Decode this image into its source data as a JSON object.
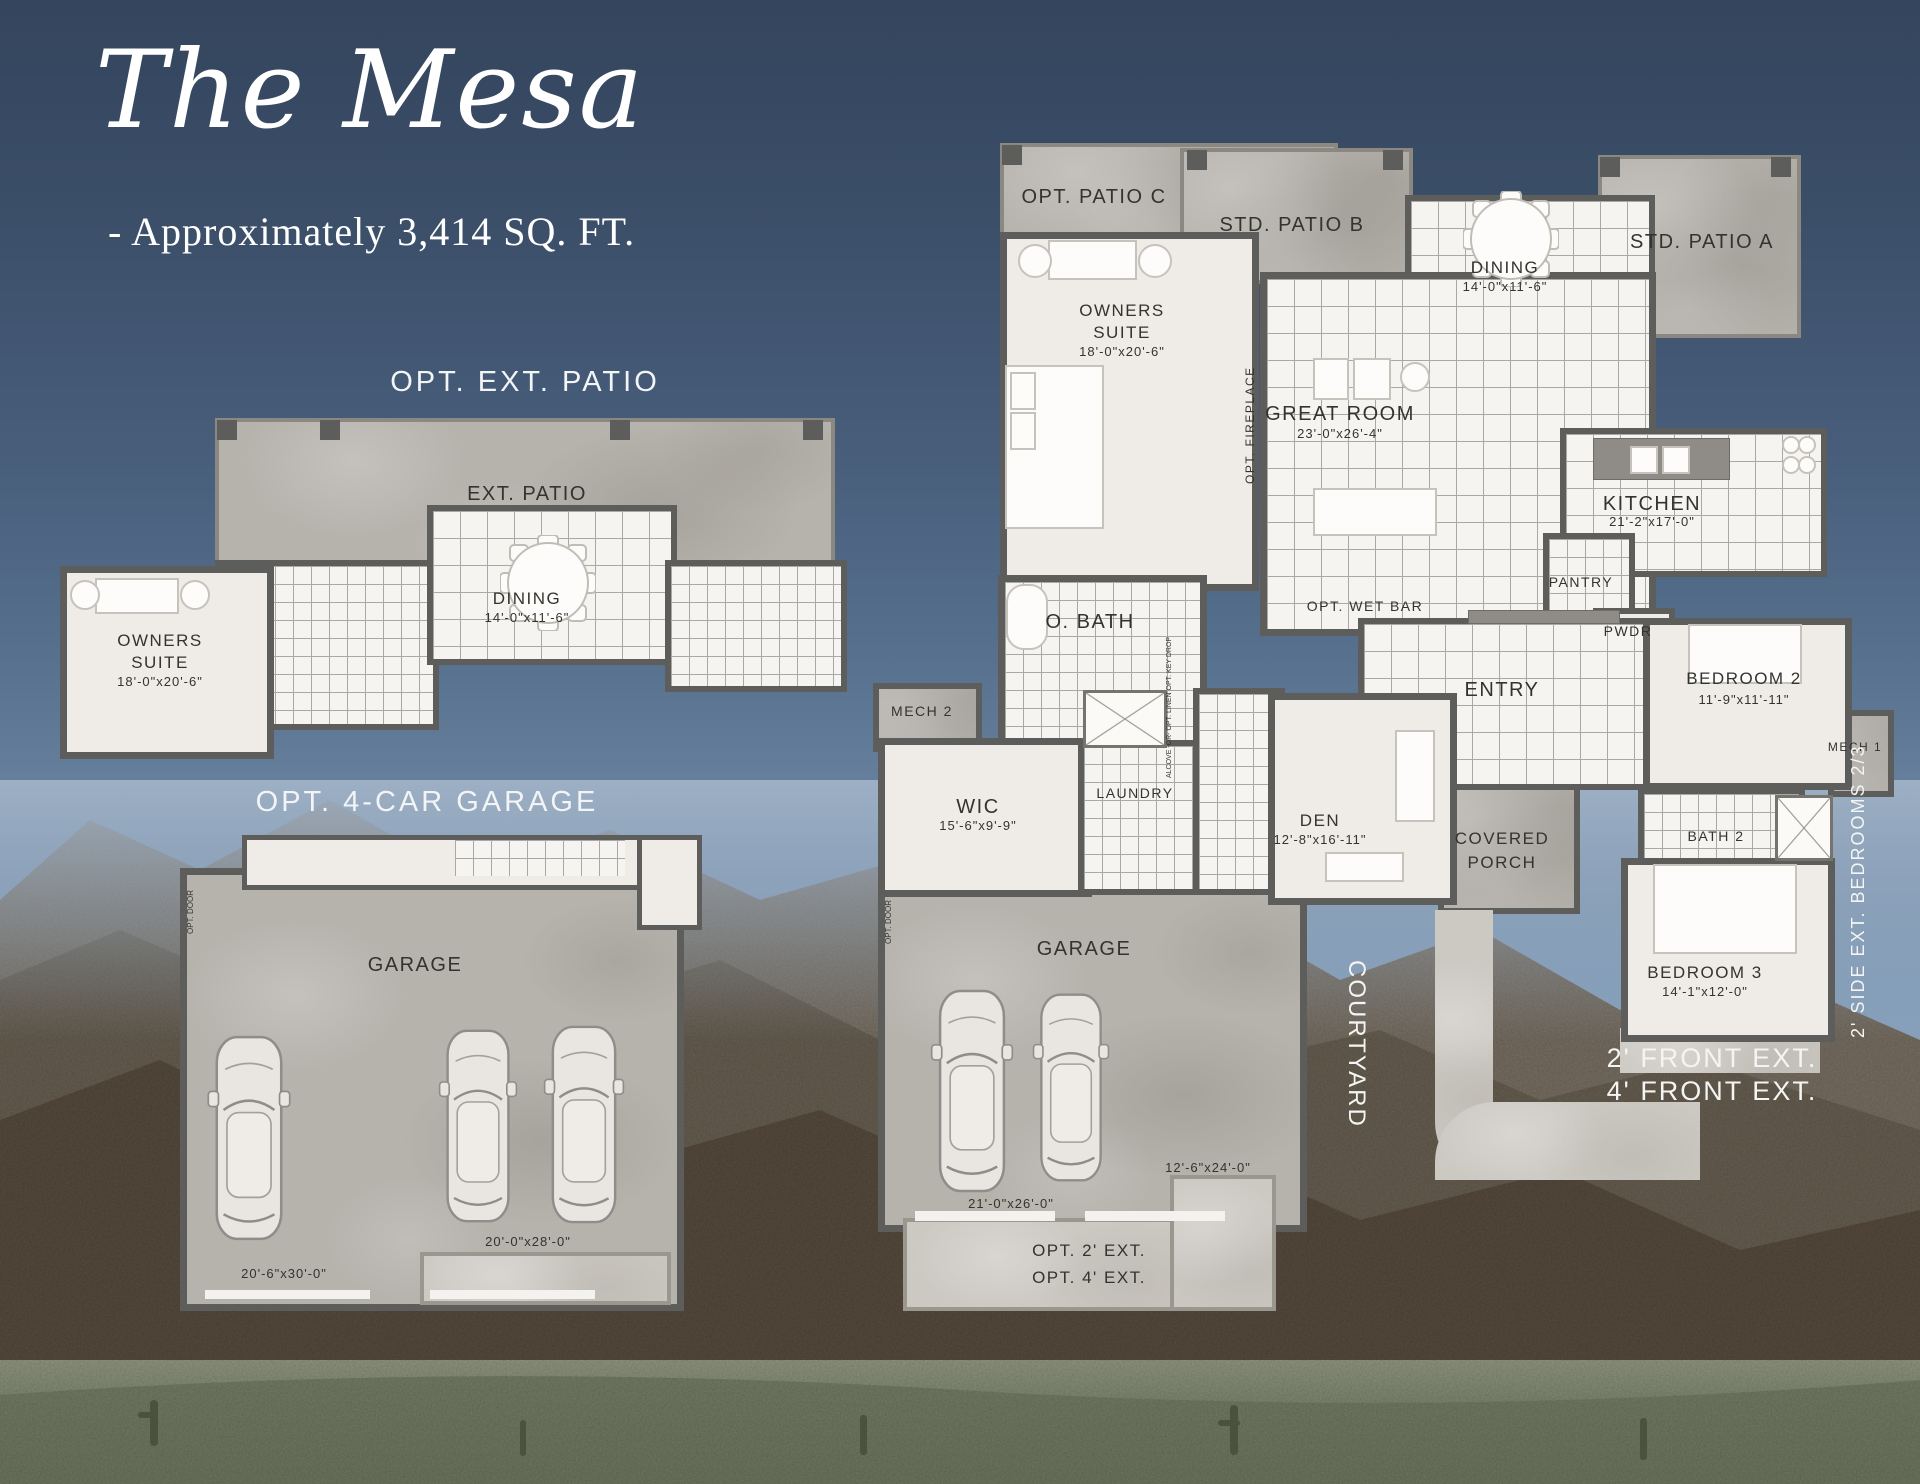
{
  "header": {
    "title": "The Mesa",
    "subtitle": "- Approximately 3,414 SQ. FT."
  },
  "left": {
    "patio_heading": "OPT. EXT. PATIO",
    "ext_patio": "EXT. PATIO",
    "dining_name": "DINING",
    "dining_dims": "14'-0\"x11'-6\"",
    "owners_line1": "OWNERS",
    "owners_line2": "SUITE",
    "owners_dims": "18'-0\"x20'-6\"",
    "garage_heading": "OPT. 4-CAR GARAGE",
    "garage_name": "GARAGE",
    "garage_dim_a": "20'-6\"x30'-0\"",
    "garage_dim_b": "20'-0\"x28'-0\"",
    "opt_door": "OPT. DOOR"
  },
  "main": {
    "opt_patio_c": "OPT. PATIO C",
    "std_patio_b": "STD. PATIO B",
    "std_patio_a": "STD. PATIO A",
    "dining_name": "DINING",
    "dining_dims": "14'-0\"x11'-6\"",
    "owners_line1": "OWNERS",
    "owners_line2": "SUITE",
    "owners_dims": "18'-0\"x20'-6\"",
    "great_room_name": "GREAT ROOM",
    "great_room_dims": "23'-0\"x26'-4\"",
    "opt_fireplace": "OPT. FIREPLACE",
    "kitchen_name": "KITCHEN",
    "kitchen_dims": "21'-2\"x17'-0\"",
    "pantry": "PANTRY",
    "pwdr": "PWDR",
    "o_bath": "O. BATH",
    "opt_wet_bar": "OPT. WET BAR",
    "entry": "ENTRY",
    "mech2": "MECH 2",
    "mech1": "MECH 1",
    "wic_name": "WIC",
    "wic_dims": "15'-6\"x9'-9\"",
    "laundry": "LAUNDRY",
    "alcove_note": "ALCOVE -OR- OPT. LINEN OPT. KEY DROP",
    "den_name": "DEN",
    "den_dims": "12'-8\"x16'-11\"",
    "porch_line1": "COVERED",
    "porch_line2": "PORCH",
    "bedroom2_name": "BEDROOM 2",
    "bedroom2_dims": "11'-9\"x11'-11\"",
    "bath2": "BATH 2",
    "bedroom3_name": "BEDROOM 3",
    "bedroom3_dims": "14'-1\"x12'-0\"",
    "garage_name": "GARAGE",
    "garage_dims": "21'-0\"x26'-0\"",
    "garage_ext_dims": "12'-6\"x24'-0\"",
    "opt_ext_line1": "OPT. 2' EXT.",
    "opt_ext_line2": "OPT. 4' EXT.",
    "courtyard": "COURTYARD",
    "front_ext_line1": "2' FRONT EXT.",
    "front_ext_line2": "4' FRONT EXT.",
    "side_ext": "2' SIDE EXT. BEDROOMS 2/3",
    "opt_door": "OPT. DOOR"
  }
}
